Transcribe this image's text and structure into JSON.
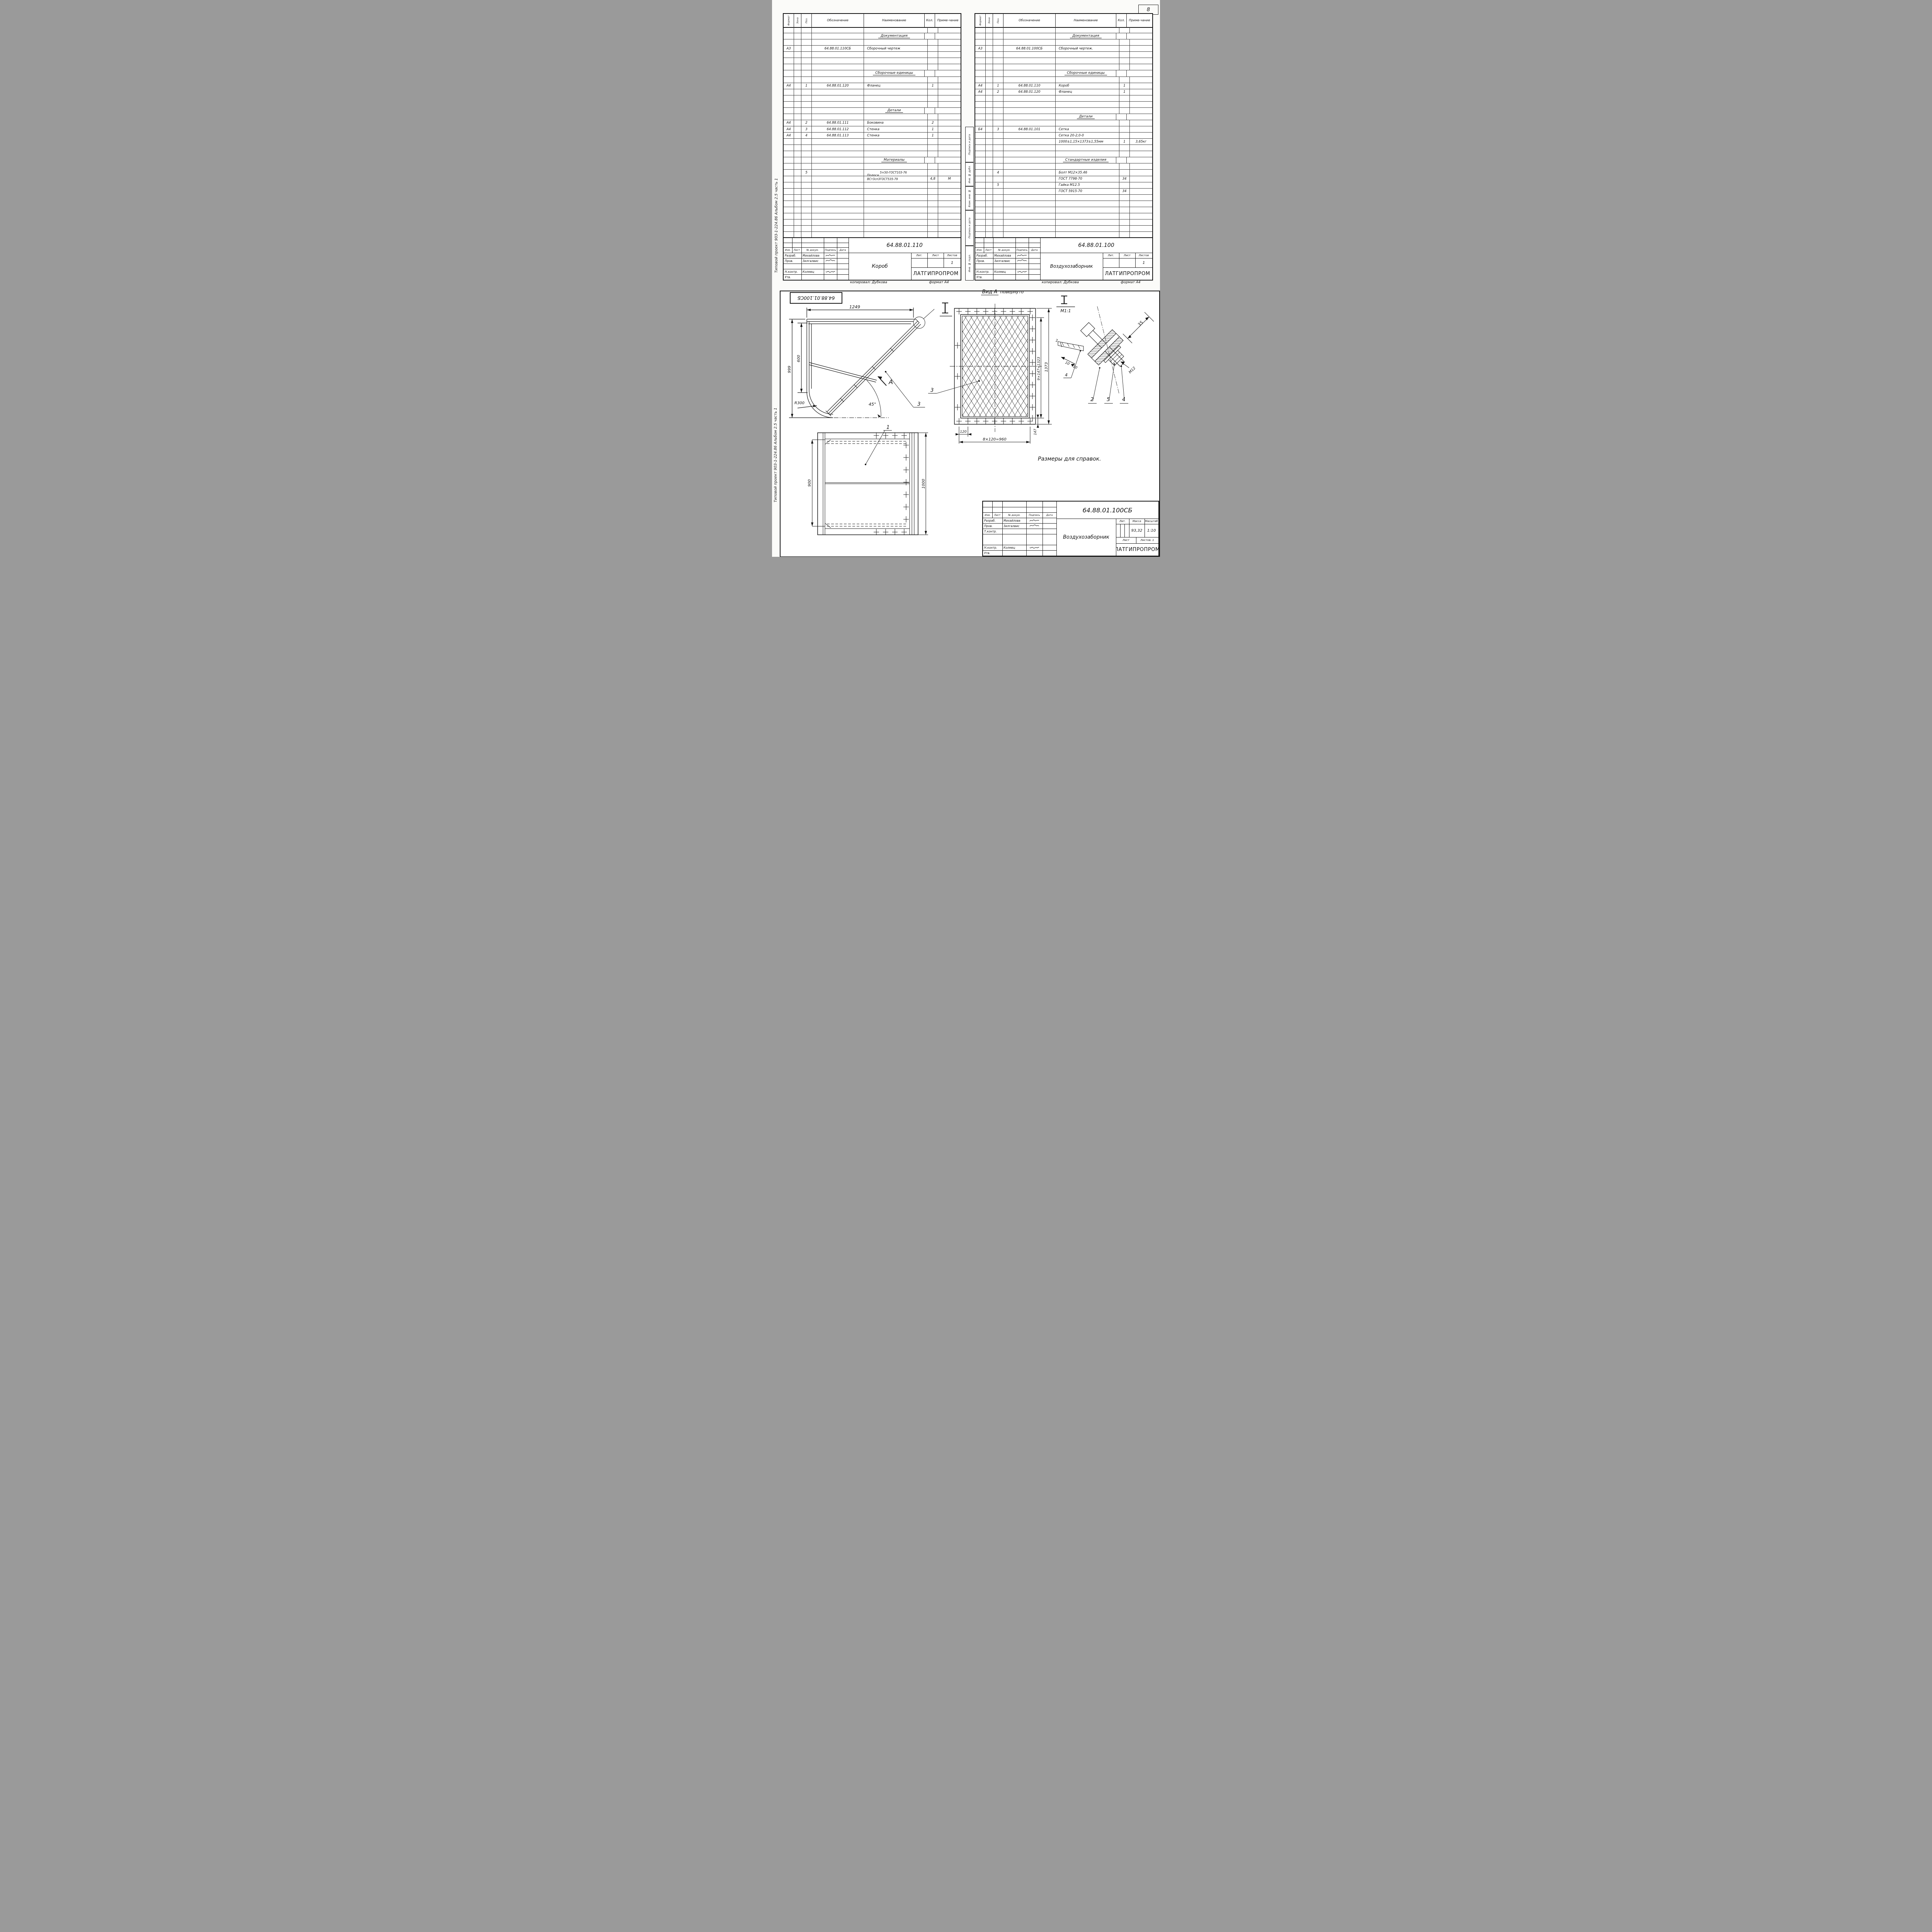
{
  "page": {
    "number": "8"
  },
  "margin_note": "Типовой проект 903-1-224.86      Альбом 2.5 часть 1",
  "stamp_fields": [
    "Подпись и дата",
    "Инв. № дубл.",
    "Взам. инв. №",
    "Подпись и дата",
    "Инв. № подл."
  ],
  "spec_header": {
    "format": "Формат",
    "zone": "Зона",
    "pos": "Поз.",
    "designation": "Обозначение",
    "name": "Наименование",
    "qty": "Кол.",
    "note": "Приме-чание"
  },
  "tables": [
    {
      "product": "Короб",
      "rows": [
        {},
        {
          "type": "section",
          "n": "Документация"
        },
        {},
        {
          "f": "А3",
          "d": "64.88.01.110СБ",
          "n": "Сборочный чертеж"
        },
        {},
        {},
        {},
        {
          "type": "section",
          "n": "Сборочные единицы"
        },
        {},
        {
          "f": "А4",
          "p": "1",
          "d": "64.88.01.120",
          "n": "Фланец",
          "q": "1"
        },
        {},
        {},
        {},
        {
          "type": "section",
          "n": "Детали"
        },
        {},
        {
          "f": "А4",
          "p": "2",
          "d": "64.88.01.111",
          "n": "Боковина",
          "q": "2"
        },
        {
          "f": "А4",
          "p": "3",
          "d": "64.88.01.112",
          "n": "Стенка",
          "q": "1"
        },
        {
          "f": "А4",
          "p": "4",
          "d": "64.88.01.113",
          "n": "Стенка",
          "q": "1"
        },
        {},
        {},
        {},
        {
          "type": "section",
          "n": "Материалы"
        },
        {},
        {
          "type": "frac-top",
          "p": "5",
          "prefix": "Полоса",
          "n": "5×50-ГОСТ103-76"
        },
        {
          "type": "frac-bottom",
          "n": "ВСт3сп3ГОСТ535-79",
          "q": "4,8",
          "note": "М"
        },
        {},
        {},
        {},
        {},
        {},
        {},
        {},
        {},
        {}
      ],
      "title_block": {
        "doc_number": "64.88.01.110",
        "rev_header": [
          "Изм.",
          "Лист",
          "№ докум.",
          "Подпись",
          "Дата"
        ],
        "people": [
          {
            "role": "Разраб.",
            "name": "Михайлова"
          },
          {
            "role": "Пров.",
            "name": "Зилгалвис"
          },
          {
            "role": "",
            "name": ""
          },
          {
            "role": "Н.контр.",
            "name": "Колмец"
          },
          {
            "role": "Утв.",
            "name": ""
          }
        ],
        "lit_header": [
          "Лит.",
          "Лист",
          "Листов"
        ],
        "sheets_value": "1",
        "org": "ЛАТГИПРОПРОМ",
        "copied": "копировал: Дубкова",
        "format": "формат А4"
      }
    },
    {
      "product": "Воздухозаборник",
      "rows": [
        {},
        {
          "type": "section",
          "n": "Документация"
        },
        {},
        {
          "f": "А3",
          "d": "64.88.01.100СБ",
          "n": "Сборочный чертеж."
        },
        {},
        {},
        {},
        {
          "type": "section",
          "n": "Сборочные единицы"
        },
        {},
        {
          "f": "А4",
          "p": "1",
          "d": "64.88.01.110",
          "n": "Короб",
          "q": "1"
        },
        {
          "f": "А4",
          "p": "2",
          "d": "64.88.01.120",
          "n": "Фланец",
          "q": "1"
        },
        {},
        {},
        {},
        {
          "type": "section",
          "n": "Детали"
        },
        {},
        {
          "f": "Б4",
          "p": "3",
          "d": "64.88.01.101",
          "n": "Сетка"
        },
        {
          "n": "Сетка 20-2,0-0"
        },
        {
          "n": "1000±1,15×1373±1,55мм",
          "q": "1",
          "note": "3,65кг"
        },
        {},
        {},
        {
          "type": "section",
          "n": "Стандартные изделия"
        },
        {},
        {
          "p": "4",
          "n": "Болт М12×35.46"
        },
        {
          "n": "ГОСТ 7798-70",
          "q": "34"
        },
        {
          "p": "5",
          "n": "Гайка М12.5"
        },
        {
          "n": "ГОСТ 5915-70",
          "q": "34"
        },
        {},
        {},
        {},
        {},
        {},
        {},
        {}
      ],
      "title_block": {
        "doc_number": "64.88.01.100",
        "rev_header": [
          "Изм.",
          "Лист",
          "№ докум.",
          "Подпись",
          "Дата"
        ],
        "people": [
          {
            "role": "Разраб.",
            "name": "Михайлова"
          },
          {
            "role": "Пров.",
            "name": "Зилгалвис"
          },
          {
            "role": "",
            "name": ""
          },
          {
            "role": "Н.контр.",
            "name": "Колмец"
          },
          {
            "role": "Утв.",
            "name": ""
          }
        ],
        "lit_header": [
          "Лит.",
          "Лист",
          "Листов"
        ],
        "sheets_value": "1",
        "org": "ЛАТГИПРОПРОМ",
        "copied": "копировал: Дубкова",
        "format": "формат А4"
      }
    }
  ],
  "main_title_block": {
    "doc_number": "64.88.01.100СБ",
    "product": "Воздухозаборник",
    "rev_header": [
      "Изм.",
      "Лист",
      "№ докум.",
      "Подпись",
      "Дата"
    ],
    "people": [
      {
        "role": "Разраб.",
        "name": "Михайлова"
      },
      {
        "role": "Пров.",
        "name": "Зилгалвис"
      },
      {
        "role": "Т.контр.",
        "name": ""
      },
      {
        "role": "Н.контр.",
        "name": "Колмец"
      },
      {
        "role": "Утв.",
        "name": ""
      }
    ],
    "props_header": [
      "Лит.",
      "Масса",
      "Масштаб"
    ],
    "mass": "93,32",
    "scale": "1:10",
    "sheet_label": "Лист",
    "sheets_label": "Листов: 1",
    "org": "ЛАТГИПРОПРОМ"
  },
  "drawings": {
    "flipped_stamp": "64.88.01.100СБ",
    "reference_note": "Размеры для справок.",
    "side_view": {
      "dim_top": "1249",
      "dim_outer": "999",
      "dim_inner": "600",
      "radius": "R300",
      "angle": "45°",
      "view_label": "А",
      "callout": "3"
    },
    "view_a": {
      "title": "Вид А",
      "subtitle": "повернуто",
      "dim_pitch_v": "9×147=1323",
      "dim_total_v": "1373",
      "dim_first": "120",
      "dim_pitch_h": "8×120=960",
      "dim_corner": "147",
      "callout": "3"
    },
    "detail": {
      "label": "М1:1",
      "dim_width": "35",
      "thread": "М12",
      "dim_a": "10",
      "dim_b": "10",
      "dim_t": "2",
      "dim_c": "4",
      "callouts": [
        "2",
        "5",
        "4"
      ]
    },
    "plan": {
      "dim_left": "900",
      "dim_right": "1000",
      "callout": "1"
    }
  }
}
